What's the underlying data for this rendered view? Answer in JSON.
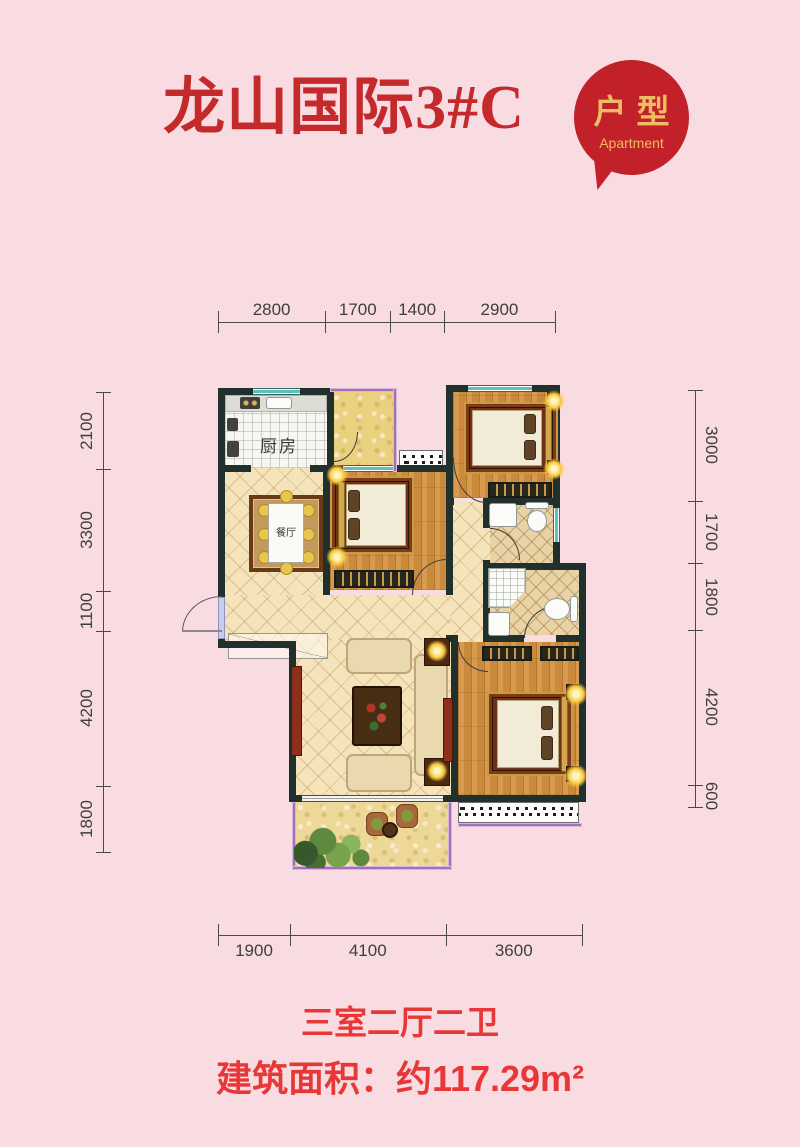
{
  "header": {
    "title": "龙山国际3#C",
    "badge_line1": "户型",
    "badge_line2": "Apartment"
  },
  "plan_labels": {
    "kitchen": "厨房",
    "dining": "餐厅"
  },
  "dimensions": {
    "top": {
      "values": [
        2800,
        1700,
        1400,
        2900
      ]
    },
    "left": {
      "values": [
        2100,
        3300,
        1100,
        4200,
        1800
      ]
    },
    "right": {
      "values": [
        3000,
        1700,
        1800,
        4200,
        600
      ]
    },
    "bottom": {
      "values": [
        1900,
        4100,
        3600
      ]
    }
  },
  "captions": {
    "layout": "三室二厅二卫",
    "area": "建筑面积：约117.29m²"
  },
  "colors": {
    "background": "#f8dce1",
    "title_red": "#c42a2c",
    "badge_red": "#c2212a",
    "badge_gold": "#ecbd62",
    "caption_red": "#e73737",
    "wall_dark": "#20302c",
    "window_teal": "#5ec0ba",
    "balcony_purple": "#a76fb8",
    "wood_floor": "#cf8e44",
    "tile_cream": "#f5e4bb"
  }
}
